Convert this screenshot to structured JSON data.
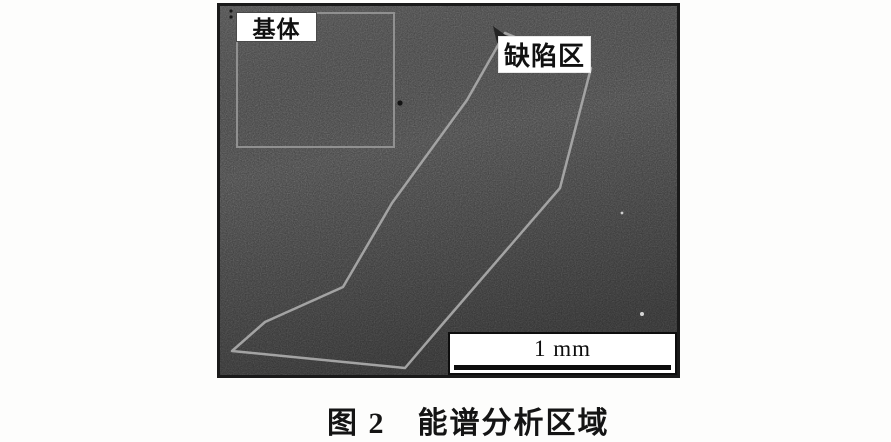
{
  "figure": {
    "type": "sem-micrograph-figure",
    "caption": "图 2　能谱分析区域",
    "labels": {
      "matrix": "基体",
      "defect": "缺陷区"
    },
    "scale_bar": {
      "label": "1 mm"
    },
    "colors": {
      "micrograph_base": "#3f3f3f",
      "micrograph_border": "#1a1a1a",
      "region_outline": "#a3a3a3",
      "matrix_outline": "#909090",
      "label_background": "#ffffff",
      "label_text": "#111111",
      "scale_bar_border": "#0d0d0d",
      "page_background": "#fdfdfc"
    }
  }
}
